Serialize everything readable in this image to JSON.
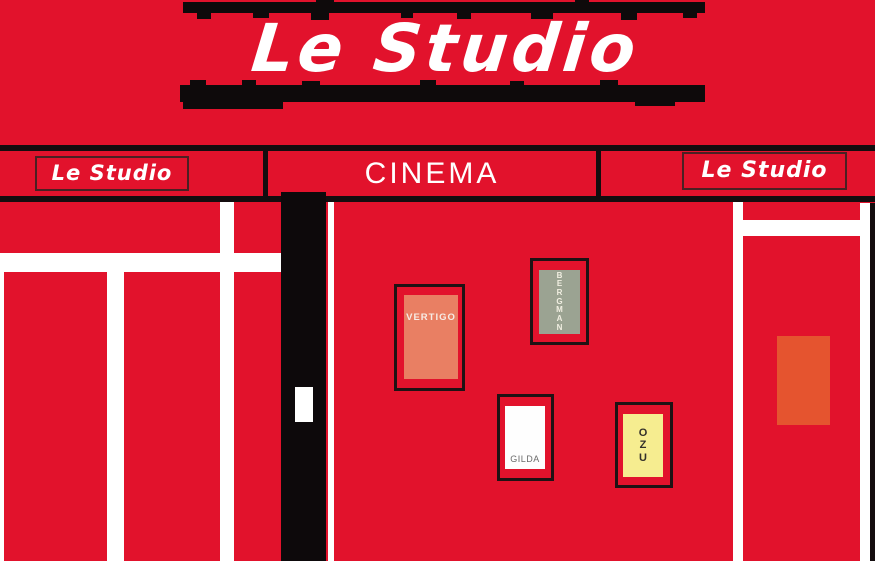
{
  "scene": {
    "description": "Flat illustration of the Le Studio cinema storefront facade"
  },
  "sign": {
    "title": "Le Studio"
  },
  "marquee": {
    "left_label": "Le Studio",
    "center_label": "CINEMA",
    "right_label": "Le Studio"
  },
  "posters": [
    {
      "title": "VERTIGO",
      "color": "#e97f63",
      "orientation": "horizontal"
    },
    {
      "title": "BERGMAN",
      "color": "#9ba392",
      "orientation": "vertical"
    },
    {
      "title": "GILDA",
      "color": "#fefefe",
      "orientation": "horizontal"
    },
    {
      "title": "OZU",
      "color": "#f6ed90",
      "orientation": "vertical"
    }
  ],
  "colors": {
    "facade_red": "#e2122c",
    "outline_black": "#140d0f",
    "stripe_white": "#ffffff",
    "door_black": "#0d090b",
    "orange_panel": "#e5542f"
  }
}
